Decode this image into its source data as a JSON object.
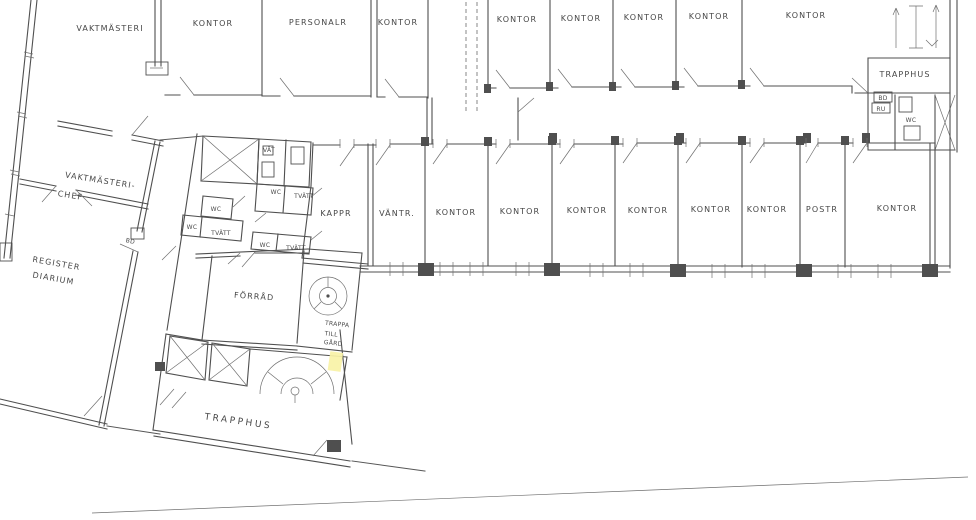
{
  "document": {
    "kind": "scanned architectural floor plan"
  },
  "colors": {
    "ink": "#4f4f4f",
    "paper": "#ffffff",
    "highlight": "#f8f2a6"
  },
  "labels": {
    "top_row": [
      "VAKTMÄSTERI",
      "KONTOR",
      "PERSONALR",
      "KONTOR",
      "KONTOR",
      "KONTOR",
      "KONTOR",
      "KONTOR",
      "KONTOR"
    ],
    "stair_top": {
      "title": "TRAPPHUS",
      "bd": "BD",
      "ru": "RU",
      "wc": "WC"
    },
    "left_block": {
      "chief1": "VAKTMÄSTERI-",
      "chief2": "CHEF",
      "bd": "BD",
      "reg1": "REGISTER",
      "reg2": "DIARIUM"
    },
    "mid_row": [
      "KAPPR",
      "VÄNTR.",
      "KONTOR",
      "KONTOR",
      "KONTOR",
      "KONTOR",
      "KONTOR",
      "KONTOR",
      "POSTR",
      "KONTOR"
    ],
    "cluster": {
      "vat": "VÄT",
      "wc_a": "WC",
      "tvatt_a": "TVÄTT",
      "wc_b": "WC",
      "wc_c": "WC",
      "tvatt_b": "TVÄTT",
      "wc_d": "WC",
      "tvatt_c": "TVÄTT",
      "forrad": "FÖRRÅD",
      "trappa_l1": "TRAPPA",
      "trappa_l2": "TILL",
      "trappa_l3": "GÅRD",
      "trapphus": "TRAPPHUS"
    }
  }
}
